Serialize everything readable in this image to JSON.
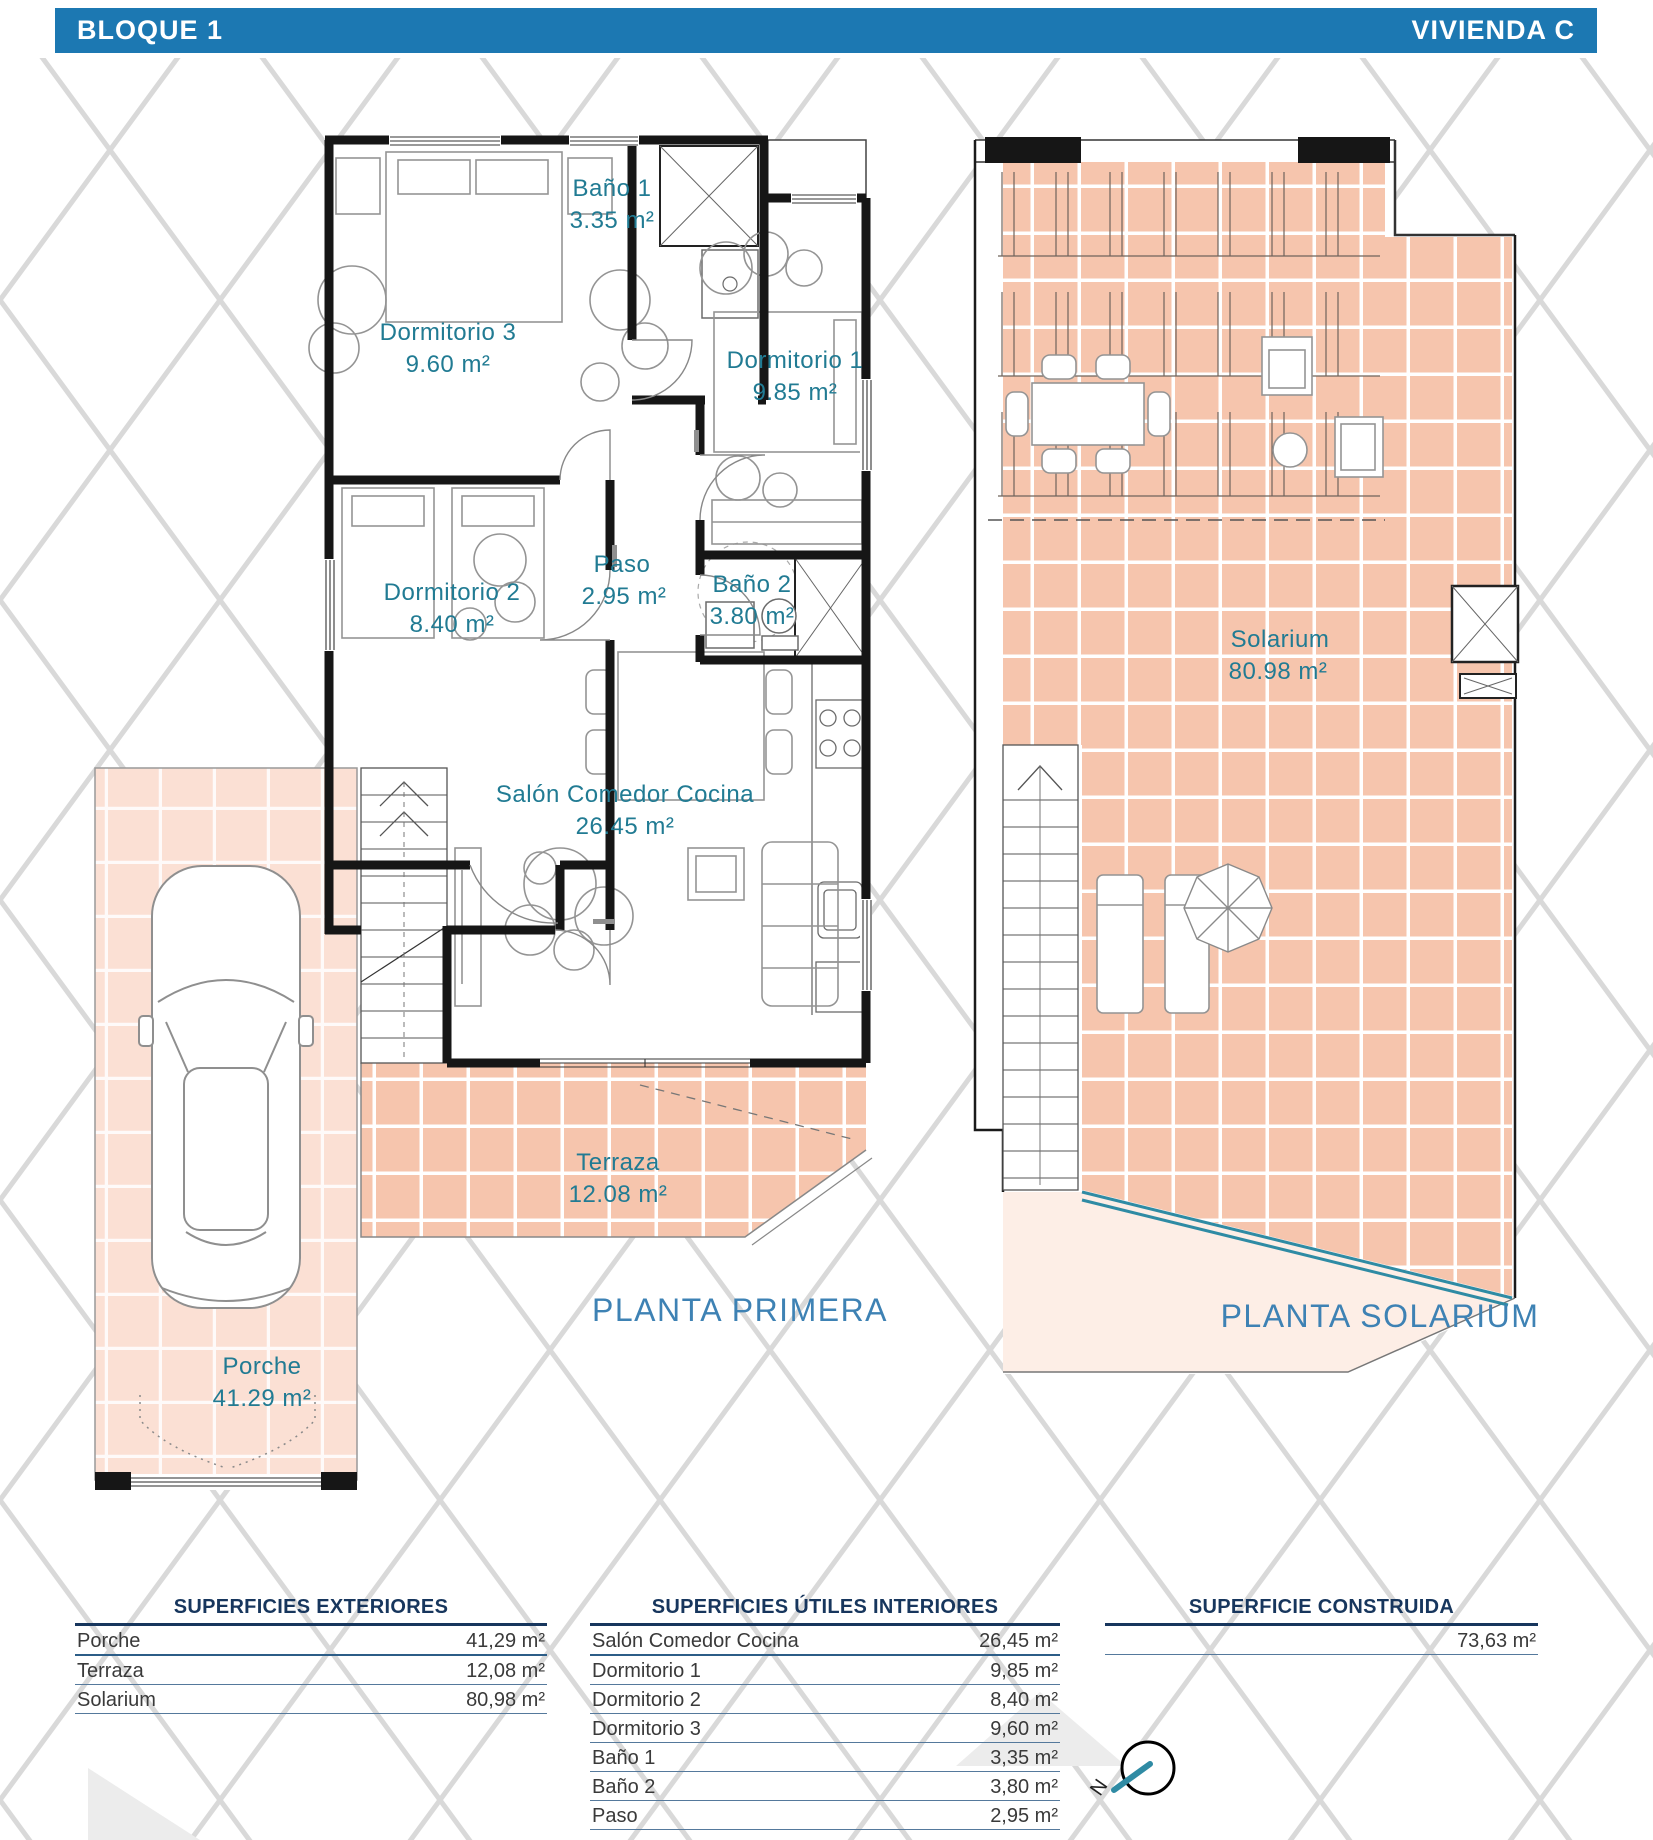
{
  "header": {
    "left": "BLOQUE 1",
    "right": "VIVIENDA C"
  },
  "plans": {
    "primera": {
      "title": "PLANTA PRIMERA",
      "rooms": [
        {
          "name": "Baño 1",
          "area": "3.35 m²"
        },
        {
          "name": "Dormitorio 3",
          "area": "9.60 m²"
        },
        {
          "name": "Dormitorio 1",
          "area": "9.85 m²"
        },
        {
          "name": "Dormitorio 2",
          "area": "8.40 m²"
        },
        {
          "name": "Paso",
          "area": "2.95 m²"
        },
        {
          "name": "Baño 2",
          "area": "3.80 m²"
        },
        {
          "name": "Salón Comedor Cocina",
          "area": "26.45 m²"
        },
        {
          "name": "Terraza",
          "area": "12.08 m²"
        },
        {
          "name": "Porche",
          "area": "41.29 m²"
        }
      ]
    },
    "solarium": {
      "title": "PLANTA SOLARIUM",
      "rooms": [
        {
          "name": "Solarium",
          "area": "80.98 m²"
        }
      ]
    }
  },
  "tables": {
    "exteriores": {
      "title": "SUPERFICIES EXTERIORES",
      "rows": [
        [
          "Porche",
          "41,29 m²"
        ],
        [
          "Terraza",
          "12,08 m²"
        ],
        [
          "Solarium",
          "80,98 m²"
        ]
      ]
    },
    "interiores": {
      "title": "SUPERFICIES ÚTILES INTERIORES",
      "rows": [
        [
          "Salón Comedor Cocina",
          "26,45 m²"
        ],
        [
          "Dormitorio 1",
          "9,85 m²"
        ],
        [
          "Dormitorio 2",
          "8,40 m²"
        ],
        [
          "Dormitorio 3",
          "9,60 m²"
        ],
        [
          "Baño 1",
          "3,35 m²"
        ],
        [
          "Baño 2",
          "3,80 m²"
        ],
        [
          "Paso",
          "2,95 m²"
        ]
      ]
    },
    "construida": {
      "title": "SUPERFICIE CONSTRUIDA",
      "rows": [
        [
          "",
          "73,63 m²"
        ]
      ]
    }
  },
  "compass": {
    "north_label": "N"
  },
  "colors": {
    "header_blue": "#1c78b2",
    "room_label": "#217b93",
    "plan_title": "#3e82b4",
    "table_navy": "#17365d",
    "tile_dark": "#f6c5ad",
    "tile_light": "#fbe0d4",
    "glass_teal": "#2f8ba4",
    "wall": "#161616",
    "lattice": "#d9d9d9"
  }
}
